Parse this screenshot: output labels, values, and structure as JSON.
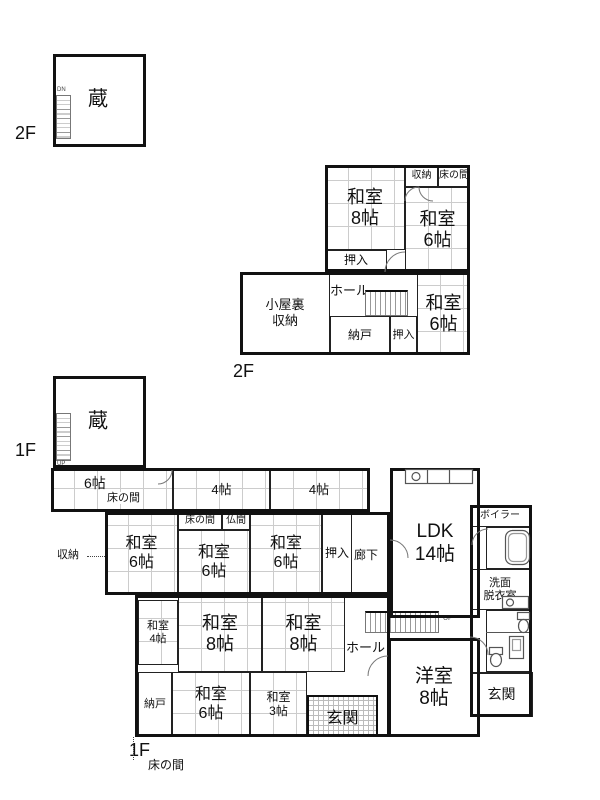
{
  "labels": {
    "floor_2f_side": "2F",
    "floor_2f_bottom": "2F",
    "floor_1f_side": "1F",
    "floor_1f_bottom": "1F"
  },
  "storage_2f": {
    "room": "蔵",
    "stair": "DN"
  },
  "storage_1f": {
    "room": "蔵",
    "stair": "UP"
  },
  "plan_2f": {
    "washitsu8": {
      "name": "和室",
      "size": "8帖"
    },
    "shuno": "収納",
    "tokonoma": "床の間",
    "washitsu6_top": {
      "name": "和室",
      "size": "6帖"
    },
    "oshiire_top": "押入",
    "hall": "ホール",
    "stair": "DN",
    "koyaura": {
      "line1": "小屋裏",
      "line2": "収納"
    },
    "nando": "納戸",
    "oshiire_bottom": "押入",
    "washitsu6_bottom": {
      "name": "和室",
      "size": "6帖"
    }
  },
  "plan_1f": {
    "room6": "6帖",
    "tokonoma_top": "床の間",
    "room4a": "4帖",
    "room4b": "4帖",
    "ldk": {
      "name": "LDK",
      "size": "14帖"
    },
    "boiler": "ボイラー",
    "senmen": {
      "line1": "洗面",
      "line2": "脱衣室"
    },
    "shuno": "収納",
    "washitsu6_a": {
      "name": "和室",
      "size": "6帖"
    },
    "tokonoma_mid": "床の間",
    "butsuma": "仏間",
    "washitsu6_b": {
      "name": "和室",
      "size": "6帖"
    },
    "washitsu6_c": {
      "name": "和室",
      "size": "6帖"
    },
    "oshiire": "押入",
    "rouka": "廊下",
    "washitsu4": {
      "name": "和室",
      "size": "4帖"
    },
    "washitsu8_a": {
      "name": "和室",
      "size": "8帖"
    },
    "washitsu8_b": {
      "name": "和室",
      "size": "8帖"
    },
    "hall": "ホール",
    "stair": "UP",
    "yoshitsu": {
      "name": "洋室",
      "size": "8帖"
    },
    "nando": "納戸",
    "washitsu6_d": {
      "name": "和室",
      "size": "6帖"
    },
    "washitsu3": {
      "name": "和室",
      "size": "3帖"
    },
    "genkan_main": "玄関",
    "genkan_side": "玄関",
    "tokonoma_bottom": "床の間"
  }
}
